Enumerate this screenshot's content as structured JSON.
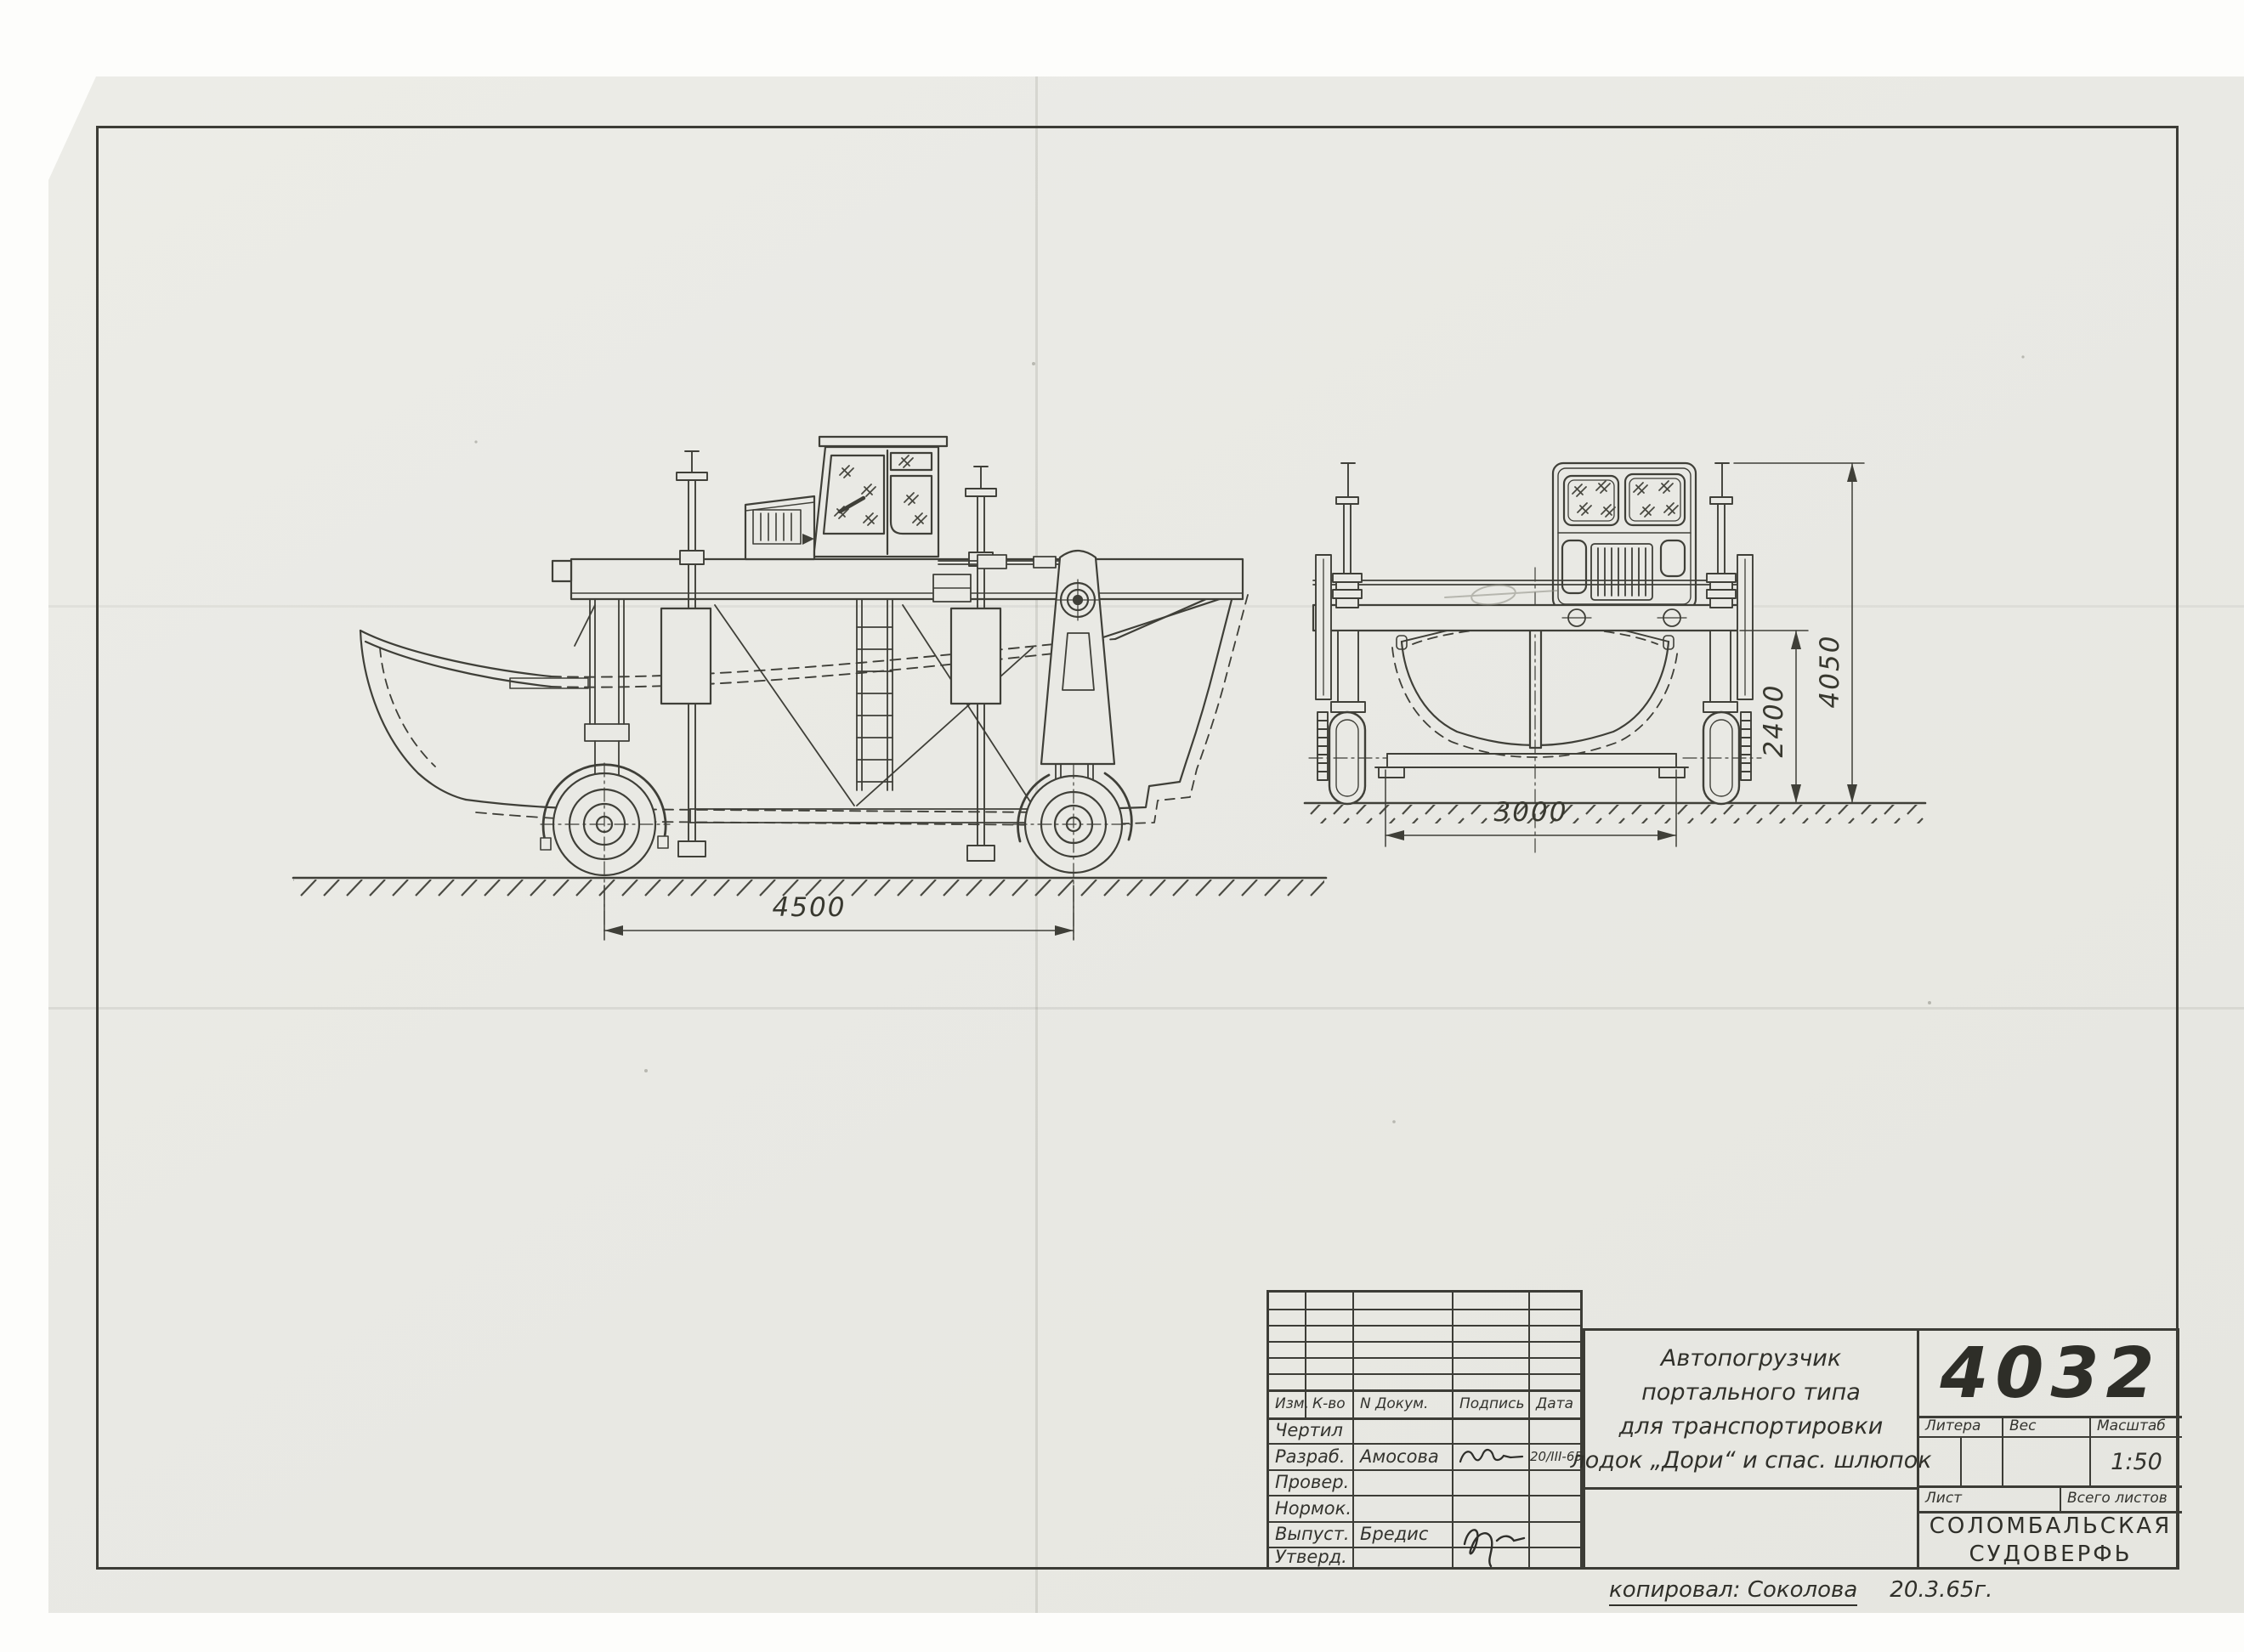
{
  "drawing": {
    "number": "4032",
    "title_lines": [
      "Автопогрузчик",
      "портального типа",
      "для транспортировки",
      "лодок „Дори“ и спас. шлюпок"
    ],
    "scale_value": "1:50",
    "company_line1": "Соломбальская",
    "company_line2": "судоверфь",
    "copied_note": "копировал: Соколова",
    "copied_date": "20.3.65г."
  },
  "title_block": {
    "headers": {
      "izm": "Изм.",
      "kvo": "К-во",
      "ndokum": "N Докум.",
      "podpis": "Подпись",
      "data": "Дата"
    },
    "rows": [
      {
        "label": "Чертил",
        "name": "",
        "date": ""
      },
      {
        "label": "Разраб.",
        "name": "Амосова",
        "date": "20/III-65"
      },
      {
        "label": "Провер.",
        "name": "",
        "date": ""
      },
      {
        "label": "Нормок.",
        "name": "",
        "date": ""
      },
      {
        "label": "Выпуст.",
        "name": "Бредис",
        "date": ""
      },
      {
        "label": "Утверд.",
        "name": "",
        "date": ""
      }
    ],
    "litera_label": "Литера",
    "ves_label": "Вес",
    "masshtab_label": "Масштаб",
    "list_label": "Лист",
    "vsego_label": "Всего листов"
  },
  "dimensions": {
    "wheelbase": "4500",
    "track": "3000",
    "portal_clearance": "2400",
    "overall_height": "4050"
  }
}
